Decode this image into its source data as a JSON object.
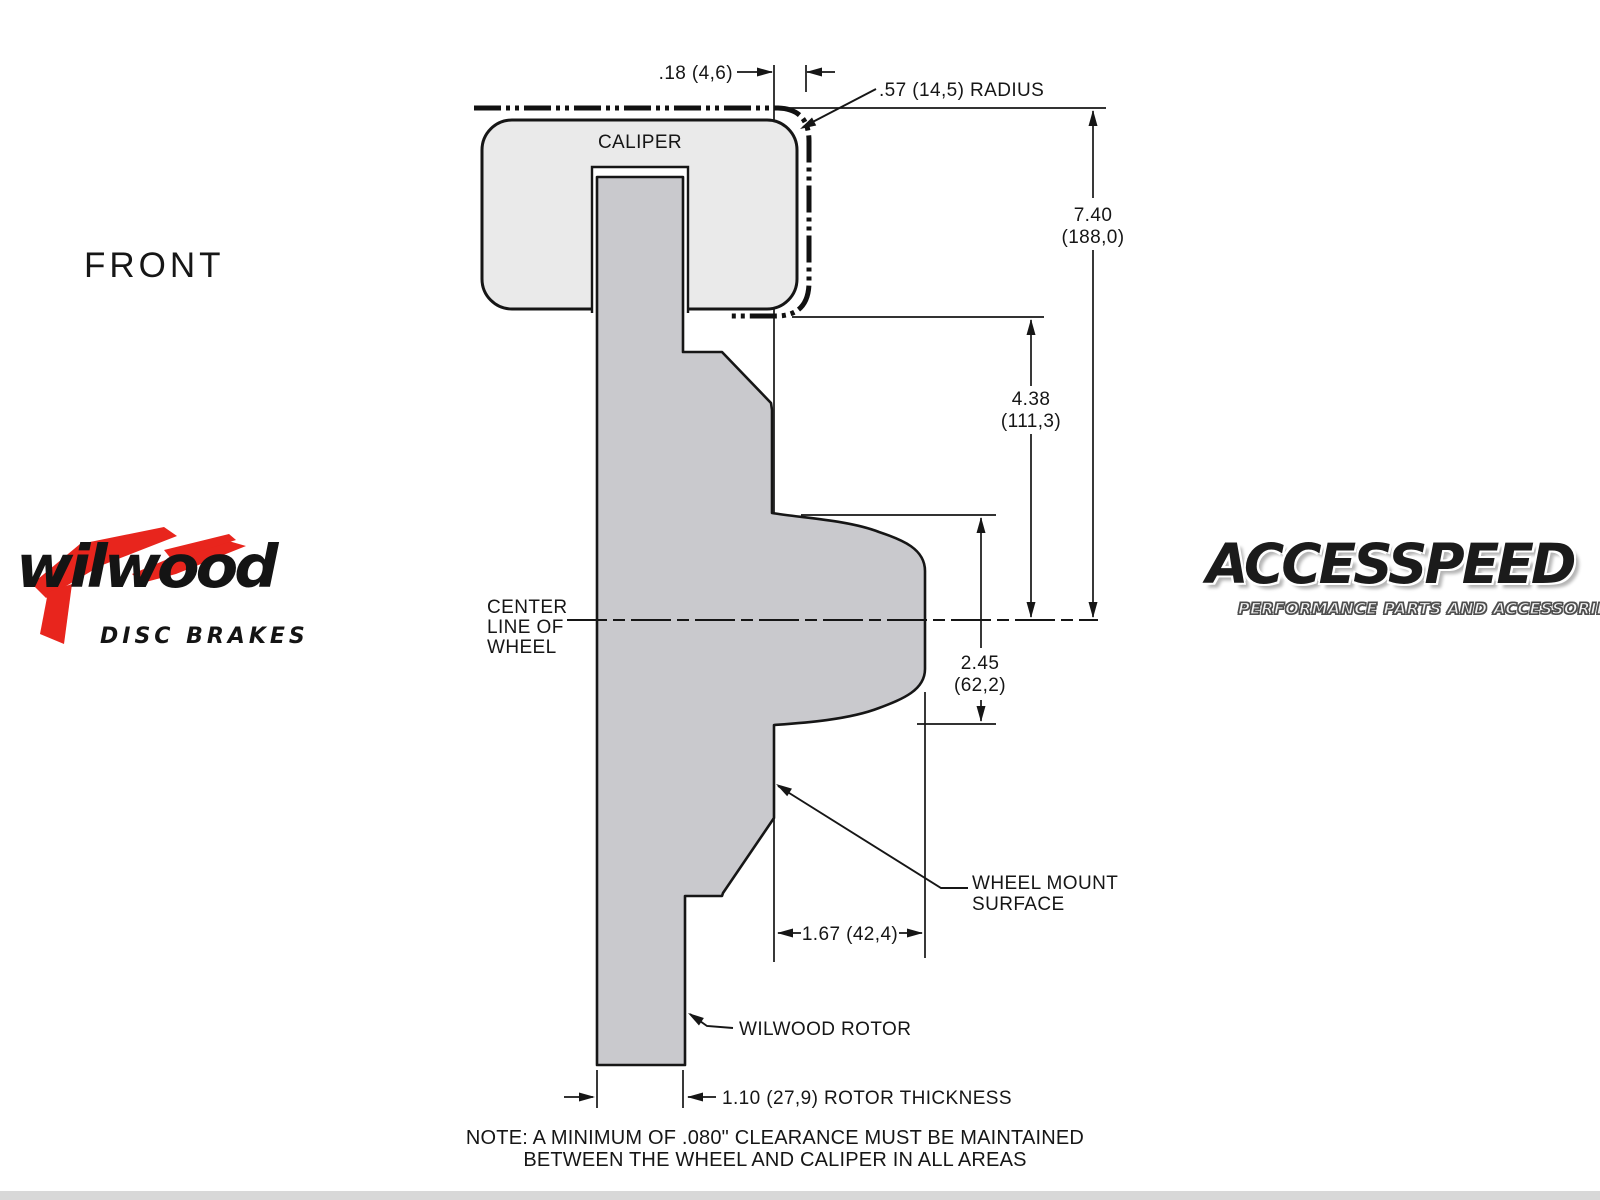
{
  "front_label": "FRONT",
  "wilwood_logo": {
    "script": "wilwood",
    "tagline": "DISC BRAKES",
    "accent_red": "#e8251d"
  },
  "accesspeed_logo": {
    "name": "ACCESSPEED",
    "tagline": "PERFORMANCE PARTS AND ACCESSORIES"
  },
  "drawing": {
    "caliper_label": "CALIPER",
    "center_line": {
      "l1": "CENTER",
      "l2": "LINE OF",
      "l3": "WHEEL"
    },
    "dims": {
      "clearance": ".18 (4,6)",
      "radius": ".57 (14,5) RADIUS",
      "overall_in": "7.40",
      "overall_mm": "(188,0)",
      "upper_in": "4.38",
      "upper_mm": "(111,3)",
      "hub_in": "2.45",
      "hub_mm": "(62,2)",
      "mount": "1.67 (42,4)",
      "thickness": "1.10 (27,9) ROTOR THICKNESS"
    },
    "labels": {
      "wheel_mount_1": "WHEEL MOUNT",
      "wheel_mount_2": "SURFACE",
      "rotor": "WILWOOD ROTOR"
    },
    "note_1": "NOTE: A MINIMUM OF .080\" CLEARANCE MUST BE MAINTAINED",
    "note_2": "BETWEEN THE WHEEL AND CALIPER IN ALL AREAS",
    "colors": {
      "caliper_fill": "#eaeaea",
      "rotor_fill": "#c9c9cd",
      "line": "#161616"
    }
  }
}
